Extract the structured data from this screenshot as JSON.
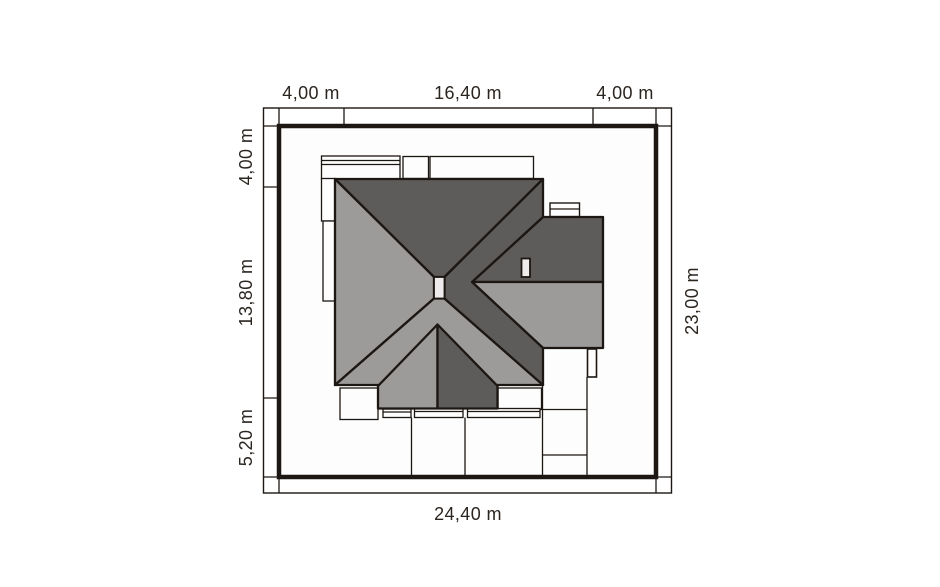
{
  "title": "Roof site plan",
  "colors": {
    "line": "#1c1713",
    "roof_dark": "#5e5b5b",
    "roof_light": "#9d9a9a",
    "chimney_fill": "#edebeb",
    "paper": "#fdfdfd",
    "text": "#2b2520"
  },
  "dimensions": {
    "top": [
      "4,00 m",
      "16,40 m",
      "4,00 m"
    ],
    "left": [
      "4,00 m",
      "13,80 m",
      "5,20 m"
    ],
    "right": [
      "23,00 m"
    ],
    "bottom": [
      "24,40 m"
    ]
  }
}
